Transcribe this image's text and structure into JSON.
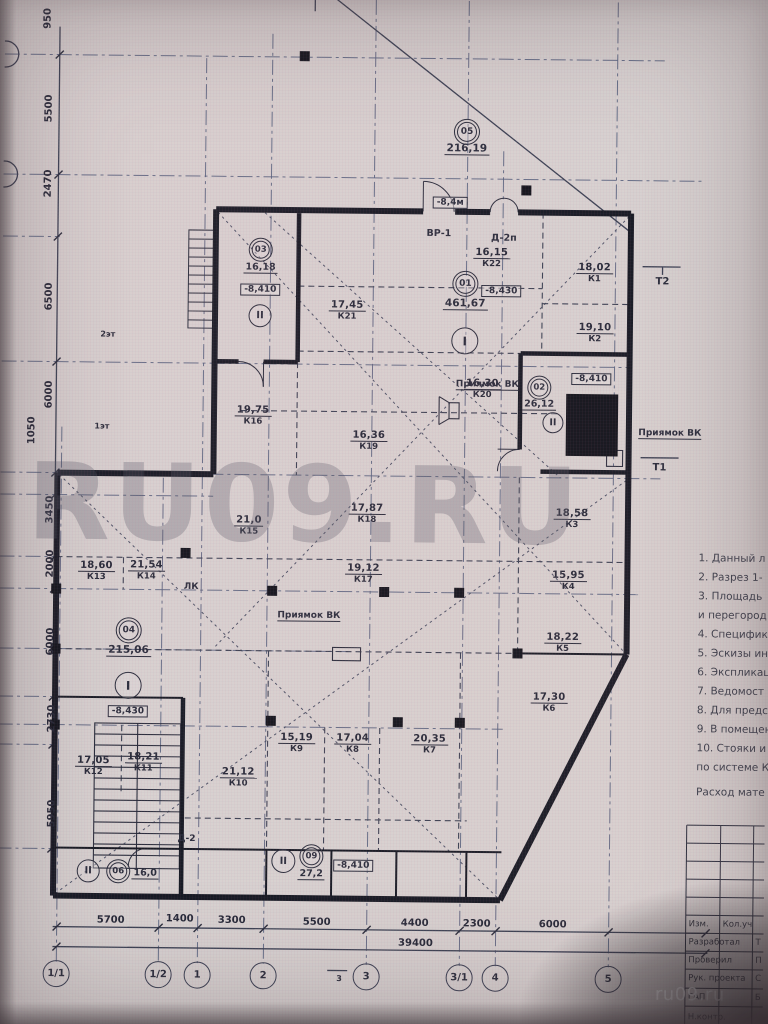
{
  "watermark": {
    "big": "RU09.RU",
    "corner": "ru09.ru"
  },
  "dims": {
    "left": [
      "950",
      "5500",
      "2470",
      "6500",
      "6000",
      "1050",
      "3450",
      "2000",
      "6000",
      "2730",
      "5950"
    ],
    "bottom": [
      "5700",
      "1400",
      "3300",
      "5500",
      "4400",
      "2300",
      "6000"
    ],
    "bottom_total": "39400"
  },
  "axes": {
    "bottom": [
      "1/1",
      "1/2",
      "1",
      "2",
      "3",
      "3/1",
      "4",
      "5"
    ]
  },
  "plan": {
    "rooms": [
      {
        "area": "16,15",
        "num": "К22"
      },
      {
        "area": "17,45",
        "num": "К21"
      },
      {
        "area": "16,30",
        "num": "К20"
      },
      {
        "area": "16,36",
        "num": "К19"
      },
      {
        "area": "19,75",
        "num": "К16"
      },
      {
        "area": "18,02",
        "num": "К1"
      },
      {
        "area": "19,10",
        "num": "К2"
      },
      {
        "area": "18,58",
        "num": "К3"
      },
      {
        "area": "15,95",
        "num": "К4"
      },
      {
        "area": "18,22",
        "num": "К5"
      },
      {
        "area": "17,30",
        "num": "К6"
      },
      {
        "area": "20,35",
        "num": "К7"
      },
      {
        "area": "17,04",
        "num": "К8"
      },
      {
        "area": "15,19",
        "num": "К9"
      },
      {
        "area": "21,12",
        "num": "К10"
      },
      {
        "area": "18,21",
        "num": "К11"
      },
      {
        "area": "17,05",
        "num": "К12"
      },
      {
        "area": "18,60",
        "num": "К13"
      },
      {
        "area": "21,54",
        "num": "К14"
      },
      {
        "area": "21,0",
        "num": "К15"
      },
      {
        "area": "17,87",
        "num": "К18"
      },
      {
        "area": "19,12",
        "num": "К17"
      }
    ],
    "stamps": {
      "top": {
        "num": "05",
        "value": "216,19"
      },
      "center": {
        "num": "01",
        "value": "461,67",
        "zone": "I",
        "level": "-8,430"
      },
      "left": {
        "num": "04",
        "value": "215,06",
        "zone": "I",
        "level": "-8,430"
      },
      "room_tl": {
        "num": "03",
        "value": "16,18",
        "zone": "II",
        "level": "-8,410"
      },
      "room_r": {
        "num": "02",
        "value": "26,12",
        "zone": "II",
        "level": "-8,410"
      },
      "entry_l": {
        "num": "06",
        "value": "16,0",
        "zone": "II"
      },
      "entry_r": {
        "num": "09",
        "value": "27,2",
        "zone": "II",
        "level": "-8,410"
      }
    },
    "labels": {
      "vr1": "ВР-1",
      "d2p": "Д-2п",
      "d2": "Д-2",
      "pit": "Приямок ВК",
      "lk": "ЛК",
      "t2": "Т2",
      "t1": "Т1",
      "fl1": "1эт",
      "fl2": "2эт",
      "top_level": "-8,4м",
      "sec3": "3"
    }
  },
  "notes": {
    "lines": [
      "1. Данный л",
      "2. Разрез 1-",
      "3. Площадь",
      "и перегород",
      "4. Специфик",
      "5. Эскизы ин",
      "6. Экспликац",
      "7. Ведомост",
      "8. Для предс",
      "9. В помещен",
      "10. Стояки и",
      "по системе К",
      "Расход мате"
    ]
  },
  "titleblock": {
    "rows": [
      {
        "l": "Изм.",
        "r": "Кол.уч"
      },
      {
        "l": "Разработал",
        "r": "Т"
      },
      {
        "l": "Проверил",
        "r": "П"
      },
      {
        "l": "Рук. проекта",
        "r": "С"
      },
      {
        "l": "ГАП",
        "r": "Б"
      },
      {
        "l": "Н.контр.",
        "r": ""
      }
    ]
  }
}
